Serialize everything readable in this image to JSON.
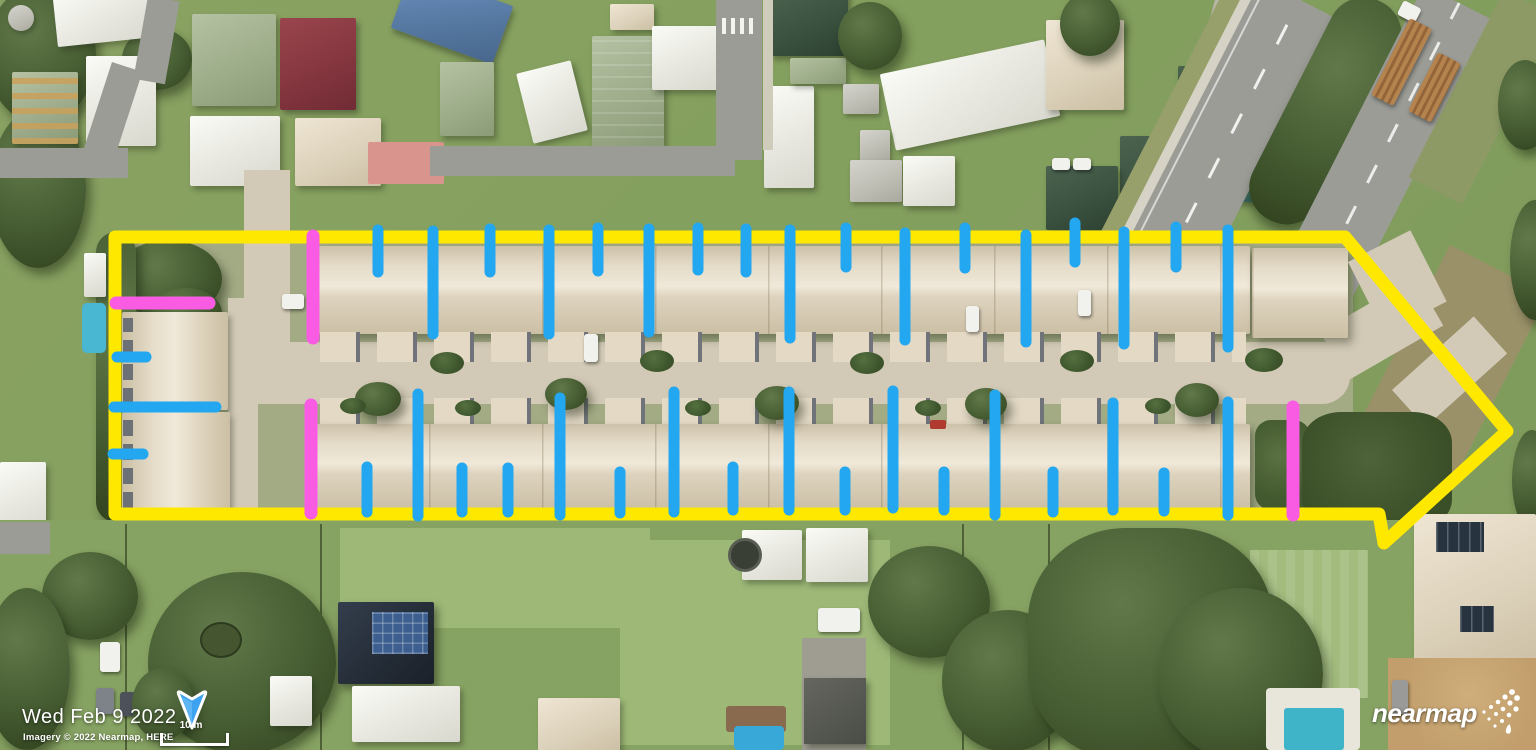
{
  "overlay": {
    "date_label": "Wed Feb 9 2022",
    "attribution": "Imagery © 2022 Nearmap, HERE",
    "scale": {
      "label": "10 m"
    },
    "logo": {
      "text": "nearmap"
    },
    "compass": {
      "direction": "north"
    }
  },
  "annotations": {
    "colors": {
      "yellow": "#FFE800",
      "blue": "#22A7F0",
      "magenta": "#F95CE3"
    },
    "stroke_widths": {
      "yellow": 13,
      "blue": 11,
      "magenta": 13
    },
    "boundary": {
      "shape": "site-outline-arrow",
      "points": [
        [
          115,
          237
        ],
        [
          1345,
          237
        ],
        [
          1507,
          431
        ],
        [
          1384,
          543
        ],
        [
          1379,
          514
        ],
        [
          115,
          514
        ]
      ]
    },
    "vertical_ticks": [
      {
        "x": 313,
        "y1": 236,
        "y2": 338,
        "color": "magenta"
      },
      {
        "x": 378,
        "y1": 230,
        "y2": 272,
        "color": "blue"
      },
      {
        "x": 433,
        "y1": 231,
        "y2": 334,
        "color": "blue"
      },
      {
        "x": 490,
        "y1": 229,
        "y2": 272,
        "color": "blue"
      },
      {
        "x": 549,
        "y1": 230,
        "y2": 334,
        "color": "blue"
      },
      {
        "x": 598,
        "y1": 228,
        "y2": 271,
        "color": "blue"
      },
      {
        "x": 649,
        "y1": 229,
        "y2": 332,
        "color": "blue"
      },
      {
        "x": 698,
        "y1": 228,
        "y2": 270,
        "color": "blue"
      },
      {
        "x": 746,
        "y1": 229,
        "y2": 272,
        "color": "blue"
      },
      {
        "x": 790,
        "y1": 230,
        "y2": 338,
        "color": "blue"
      },
      {
        "x": 846,
        "y1": 228,
        "y2": 267,
        "color": "blue"
      },
      {
        "x": 905,
        "y1": 233,
        "y2": 340,
        "color": "blue"
      },
      {
        "x": 965,
        "y1": 228,
        "y2": 268,
        "color": "blue"
      },
      {
        "x": 1026,
        "y1": 235,
        "y2": 342,
        "color": "blue"
      },
      {
        "x": 1075,
        "y1": 223,
        "y2": 262,
        "color": "blue"
      },
      {
        "x": 1124,
        "y1": 232,
        "y2": 344,
        "color": "blue"
      },
      {
        "x": 1176,
        "y1": 227,
        "y2": 267,
        "color": "blue"
      },
      {
        "x": 1228,
        "y1": 230,
        "y2": 347,
        "color": "blue"
      },
      {
        "x": 311,
        "y1": 405,
        "y2": 513,
        "color": "magenta"
      },
      {
        "x": 367,
        "y1": 467,
        "y2": 512,
        "color": "blue"
      },
      {
        "x": 418,
        "y1": 394,
        "y2": 516,
        "color": "blue"
      },
      {
        "x": 462,
        "y1": 468,
        "y2": 512,
        "color": "blue"
      },
      {
        "x": 508,
        "y1": 468,
        "y2": 512,
        "color": "blue"
      },
      {
        "x": 560,
        "y1": 398,
        "y2": 515,
        "color": "blue"
      },
      {
        "x": 620,
        "y1": 472,
        "y2": 513,
        "color": "blue"
      },
      {
        "x": 674,
        "y1": 392,
        "y2": 512,
        "color": "blue"
      },
      {
        "x": 733,
        "y1": 467,
        "y2": 510,
        "color": "blue"
      },
      {
        "x": 789,
        "y1": 392,
        "y2": 510,
        "color": "blue"
      },
      {
        "x": 845,
        "y1": 472,
        "y2": 510,
        "color": "blue"
      },
      {
        "x": 893,
        "y1": 391,
        "y2": 508,
        "color": "blue"
      },
      {
        "x": 944,
        "y1": 472,
        "y2": 510,
        "color": "blue"
      },
      {
        "x": 995,
        "y1": 395,
        "y2": 515,
        "color": "blue"
      },
      {
        "x": 1053,
        "y1": 472,
        "y2": 512,
        "color": "blue"
      },
      {
        "x": 1113,
        "y1": 403,
        "y2": 510,
        "color": "blue"
      },
      {
        "x": 1164,
        "y1": 473,
        "y2": 511,
        "color": "blue"
      },
      {
        "x": 1228,
        "y1": 402,
        "y2": 515,
        "color": "blue"
      },
      {
        "x": 1293,
        "y1": 407,
        "y2": 515,
        "color": "magenta"
      }
    ],
    "horizontal_ticks": [
      {
        "y": 303,
        "x1": 116,
        "x2": 209,
        "color": "magenta"
      },
      {
        "y": 357,
        "x1": 117,
        "x2": 146,
        "color": "blue"
      },
      {
        "y": 407,
        "x1": 114,
        "x2": 216,
        "color": "blue"
      },
      {
        "y": 454,
        "x1": 113,
        "x2": 143,
        "color": "blue"
      }
    ]
  }
}
